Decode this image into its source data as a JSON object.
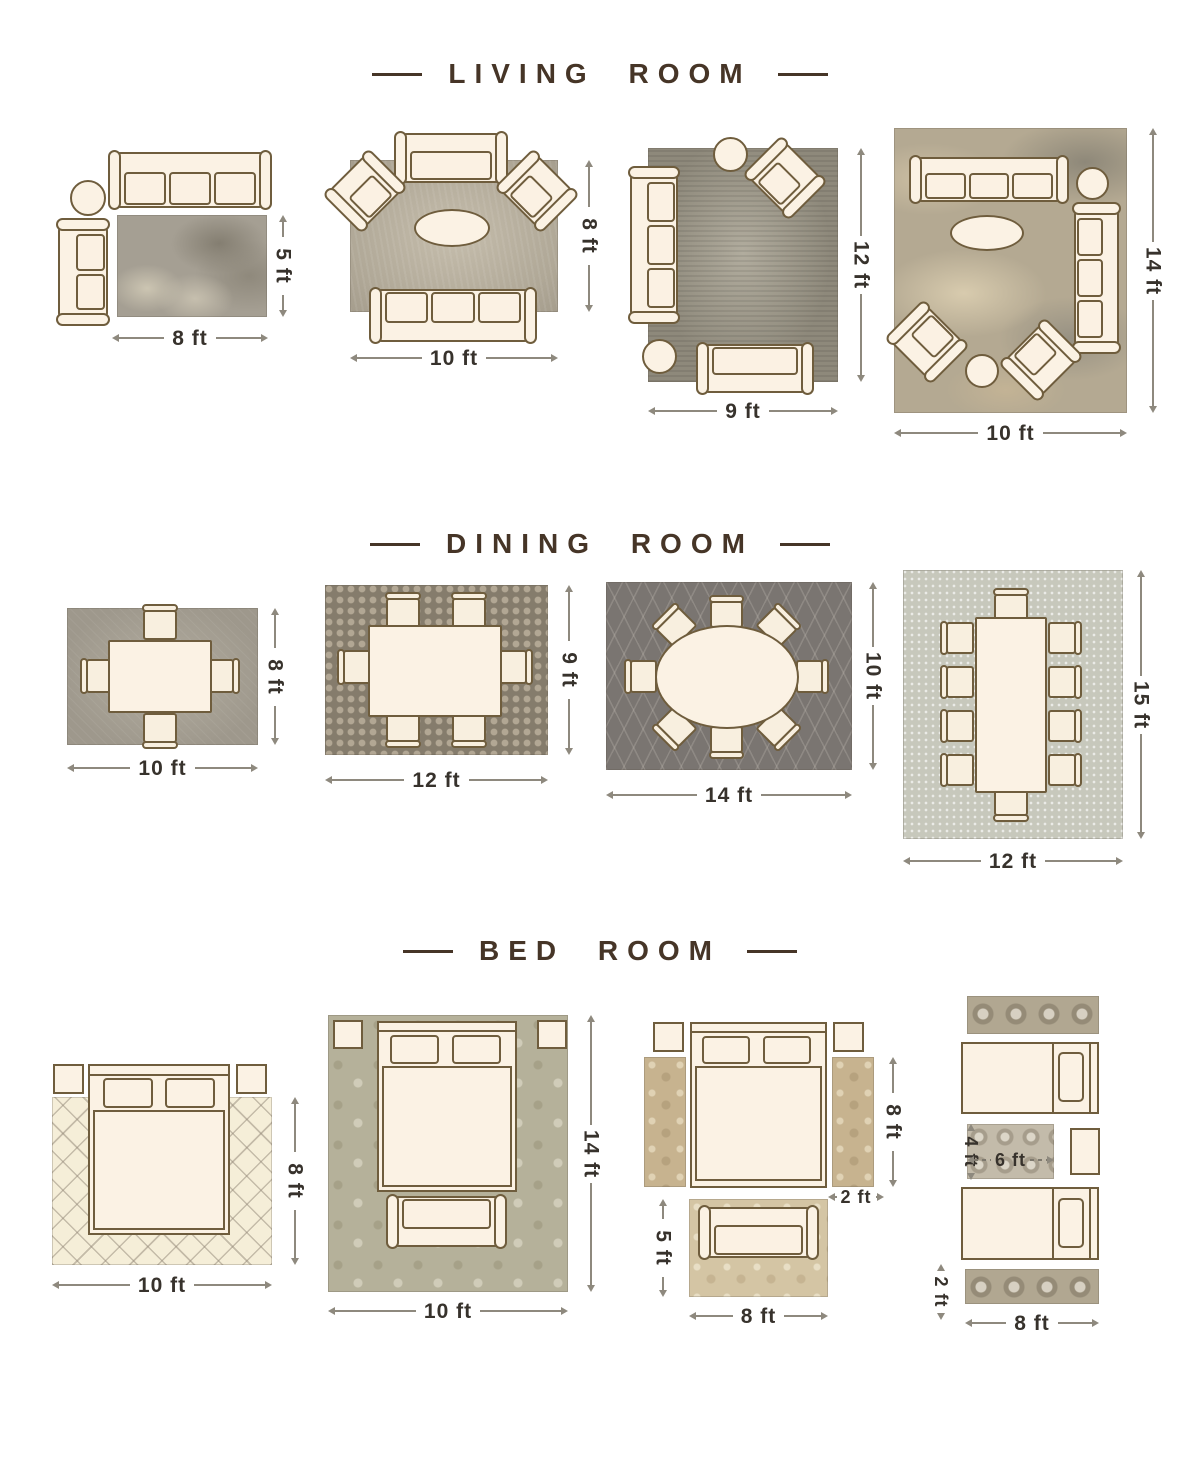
{
  "colors": {
    "title": "#463527",
    "dimension_text": "#37322c",
    "dimension_line": "#8e897e",
    "furniture_fill": "#fbf2e4",
    "furniture_outline": "#6f5d3d"
  },
  "sections": [
    {
      "title": "LIVING ROOM",
      "layouts": [
        {
          "width_label": "8 ft",
          "height_label": "5 ft"
        },
        {
          "width_label": "10 ft",
          "height_label": "8 ft"
        },
        {
          "width_label": "9 ft",
          "height_label": "12 ft"
        },
        {
          "width_label": "10 ft",
          "height_label": "14 ft"
        }
      ]
    },
    {
      "title": "DINING ROOM",
      "layouts": [
        {
          "width_label": "10 ft",
          "height_label": "8 ft"
        },
        {
          "width_label": "12 ft",
          "height_label": "9 ft"
        },
        {
          "width_label": "14 ft",
          "height_label": "10 ft"
        },
        {
          "width_label": "12 ft",
          "height_label": "15 ft"
        }
      ]
    },
    {
      "title": "BED ROOM",
      "layouts": [
        {
          "width_label": "10 ft",
          "height_label": "8 ft"
        },
        {
          "width_label": "10 ft",
          "height_label": "14 ft"
        },
        {
          "width_label": "8 ft",
          "runner_height_label": "8 ft",
          "runner_width_label": "2 ft",
          "foot_rug_height_label": "5 ft"
        },
        {
          "width_label": "8 ft",
          "middle_rug_height_label": "4 ft",
          "middle_rug_width_label": "6 ft",
          "runner_width_label": "2 ft"
        }
      ]
    }
  ]
}
